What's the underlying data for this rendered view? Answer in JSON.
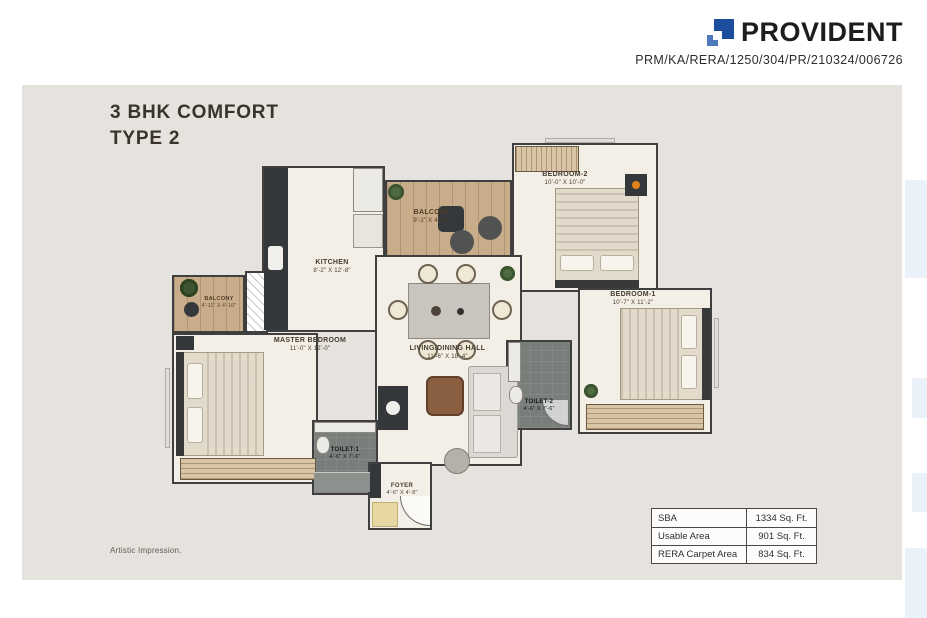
{
  "header": {
    "brand": "PROVIDENT",
    "rera_number": "PRM/KA/RERA/1250/304/PR/210324/006726"
  },
  "title": {
    "line1": "3 BHK COMFORT",
    "line2": "TYPE 2"
  },
  "footnote": "Artistic Impression.",
  "area_table": {
    "rows": [
      {
        "label": "SBA",
        "value": "1334 Sq. Ft."
      },
      {
        "label": "Usable Area",
        "value": "901 Sq. Ft."
      },
      {
        "label": "RERA Carpet Area",
        "value": "834 Sq. Ft."
      }
    ]
  },
  "floorplan": {
    "rooms": [
      {
        "name": "KITCHEN",
        "dimensions": "8'-2\" X 12'-8\""
      },
      {
        "name": "BALCONY",
        "dimensions": "9'-2\" X 4'-10\""
      },
      {
        "name": "BEDROOM-2",
        "dimensions": "10'-0\" X 10'-0\""
      },
      {
        "name": "BEDROOM-1",
        "dimensions": "10'-7\" X 11'-2\""
      },
      {
        "name": "LIVING/DINING HALL",
        "dimensions": "11'-6\" X 18'-4\""
      },
      {
        "name": "MASTER BEDROOM",
        "dimensions": "11'-0\" X 12'-0\""
      },
      {
        "name": "BALCONY",
        "dimensions": "4'-11\" X 4'-10\""
      },
      {
        "name": "TOILET-1",
        "dimensions": "4'-6\" X 7'-6\""
      },
      {
        "name": "TOILET-2",
        "dimensions": "4'-6\" X 7'-6\""
      },
      {
        "name": "FOYER",
        "dimensions": "4'-6\" X 4'-8\""
      }
    ]
  },
  "colors": {
    "brand_blue": "#1d4e9e",
    "panel_beige": "#e6e2dd",
    "accent_orange": "#e0821c"
  }
}
